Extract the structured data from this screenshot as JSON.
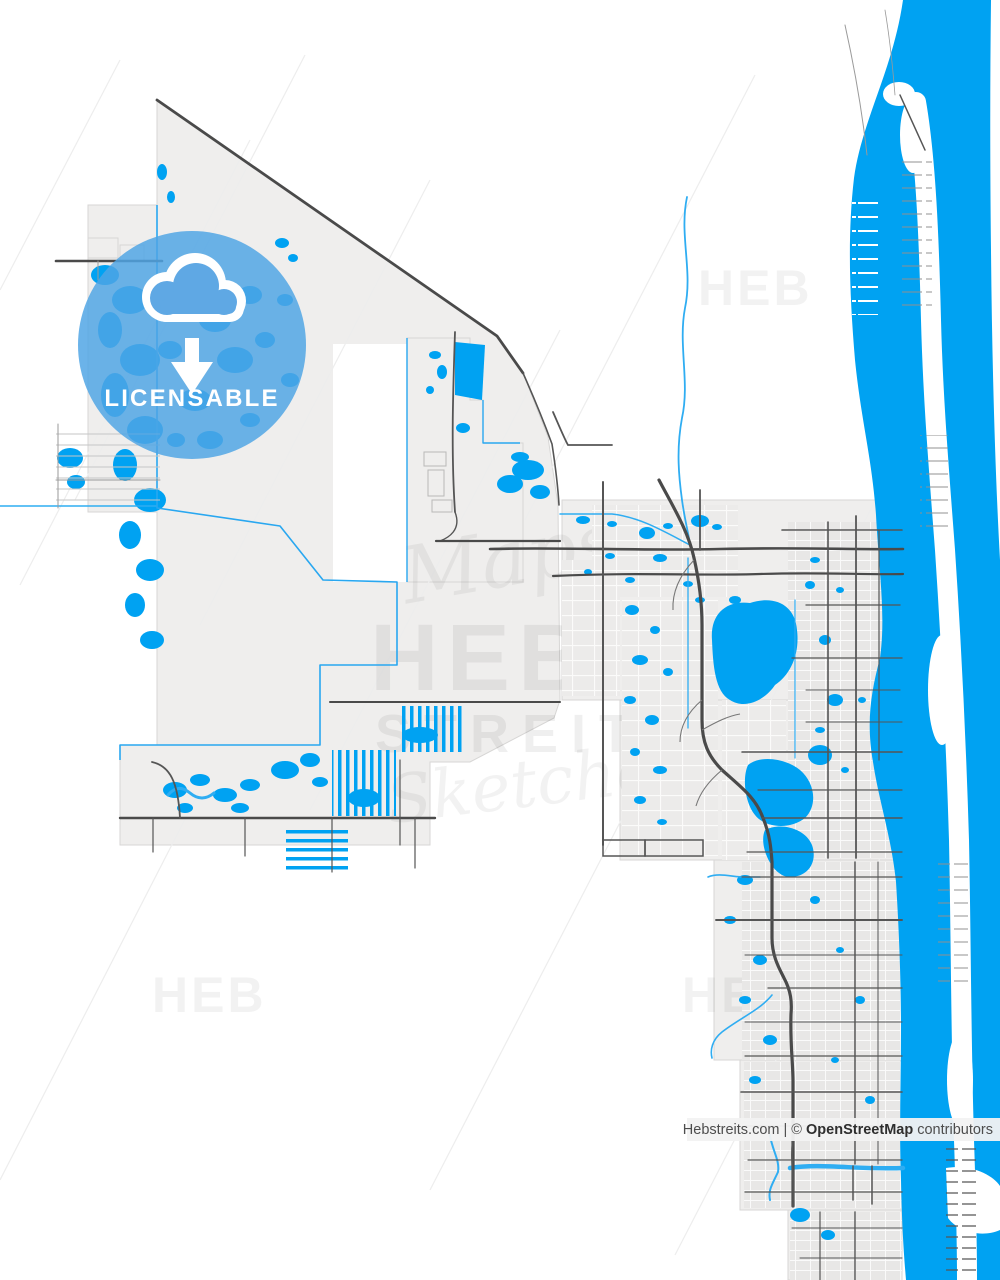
{
  "page": {
    "width": 1000,
    "height": 1280,
    "background": "#ffffff"
  },
  "badge": {
    "label": "LICENSABLE",
    "icon": "cloud-download",
    "circle_color": "#4FA5E5",
    "text_color": "#ffffff"
  },
  "watermark": {
    "script_top": "Maps",
    "brand": "HEB",
    "brand_sub": "STREITS",
    "script_bottom": "Sketches",
    "corner_brand": "HEB"
  },
  "attribution": {
    "site": "Hebstreits.com",
    "mid": " | © ",
    "source": "OpenStreetMap",
    "suffix": " contributors"
  },
  "map": {
    "colors": {
      "water": "#00A2F2",
      "water_line": "#2FADF2",
      "city_boundary": "#29A7F0",
      "land": "#EFEEED",
      "road_major": "#4A4A4A",
      "road_minor": "#B5B5B5",
      "urban_block": "#E8E7E6"
    },
    "features": [
      "city boundary",
      "wetland ponds",
      "lakes",
      "canals",
      "residential canal fingers",
      "suburban grid",
      "highway with interchanges",
      "coastal lagoon",
      "barrier island",
      "ocean"
    ]
  }
}
